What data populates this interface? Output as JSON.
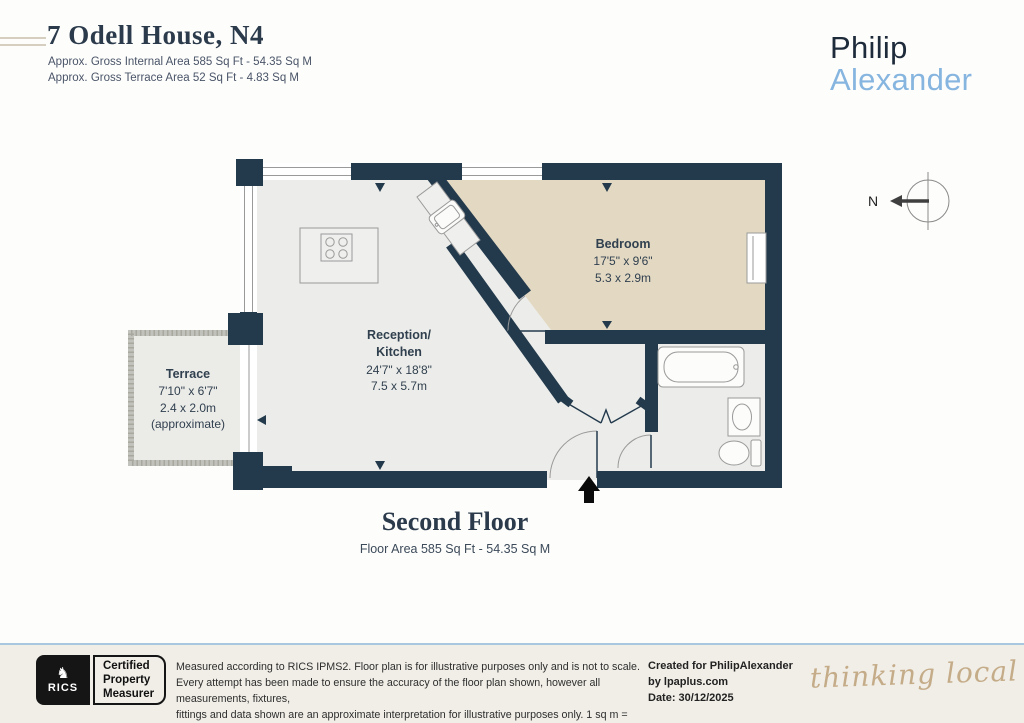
{
  "header": {
    "title": "7 Odell House, N4",
    "area_line1": "Approx. Gross Internal Area 585 Sq Ft - 54.35 Sq M",
    "area_line2": "Approx. Gross Terrace Area 52 Sq Ft - 4.83 Sq M",
    "brand": {
      "line1": "Philip",
      "line2": "Alexander"
    }
  },
  "compass": {
    "label": "N"
  },
  "plan": {
    "rooms": {
      "bedroom": {
        "name": "Bedroom",
        "dims_imperial": "17'5\" x 9'6\"",
        "dims_metric": "5.3 x 2.9m"
      },
      "reception": {
        "name_line1": "Reception/",
        "name_line2": "Kitchen",
        "dims_imperial": "24'7\" x 18'8\"",
        "dims_metric": "7.5 x 5.7m"
      },
      "terrace": {
        "name": "Terrace",
        "dims_imperial": "7'10\" x 6'7\"",
        "dims_metric": "2.4 x 2.0m",
        "note": "(approximate)"
      }
    }
  },
  "floor_label": {
    "title": "Second Floor",
    "subtitle": "Floor Area 585 Sq Ft - 54.35 Sq M"
  },
  "footer": {
    "rics": {
      "brand": "RICS",
      "lion_glyph": "♞",
      "certification": [
        "Certified",
        "Property",
        "Measurer"
      ]
    },
    "disclaimer_lines": [
      "Measured according to RICS IPMS2. Floor plan is for illustrative purposes only and is not to scale.",
      "Every attempt has been made to ensure the accuracy of the floor plan shown, however all measurements, fixtures,",
      "fittings and data shown are an approximate interpretation for illustrative purposes only. 1 sq m = 10.76 sq feet."
    ],
    "credits": {
      "line1": "Created for PhilipAlexander",
      "line2": "by lpaplus.com",
      "line3": "Date: 30/12/2025"
    },
    "tagline": "thinking local"
  },
  "colors": {
    "wall": "#233A4D",
    "floor_fill": "#ECEDEA",
    "bedroom_fill": "#E3D9C3",
    "brand_navy": "#1E2B3A",
    "brand_blue": "#86B5DF",
    "footer_bg": "#F1EEE7",
    "footer_rule": "#A9C8E0",
    "tagline_tan": "#C5AC89"
  }
}
